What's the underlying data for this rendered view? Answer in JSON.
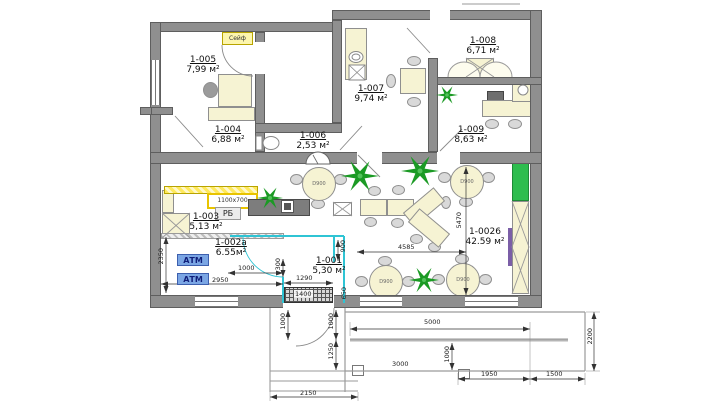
{
  "rooms": {
    "r1005": {
      "id": "1-005",
      "area": "7,99 м²"
    },
    "r1004": {
      "id": "1-004",
      "area": "6,88 м²"
    },
    "r1006": {
      "id": "1-006",
      "area": "2,53 м²"
    },
    "r1007": {
      "id": "1-007",
      "area": "9,74 м²"
    },
    "r1008": {
      "id": "1-008",
      "area": "6,71 м²"
    },
    "r1009": {
      "id": "1-009",
      "area": "8,63 м²"
    },
    "r1003": {
      "id": "1-003",
      "area": "5,13 м²"
    },
    "r1002a": {
      "id": "1-002а",
      "area": "6.55м²"
    },
    "r1001": {
      "id": "1-001",
      "area": "5,30 м²"
    },
    "r10026": {
      "id": "1-0026",
      "area": "42.59 м²"
    }
  },
  "labels": {
    "safe": "Сейф",
    "atm": "АТМ",
    "cash_desk": "РБ",
    "desk_size": "1100x700",
    "round_table": "D900"
  },
  "dimensions": {
    "d2350": "2350",
    "d2950": "2950",
    "d1000_atm": "1000",
    "d300": "300",
    "d900": "900",
    "d1290": "1290",
    "d1400": "1400",
    "d650": "650",
    "d4585": "4585",
    "d5470": "5470",
    "d5000": "5000",
    "d3000": "3000",
    "d1000_porch": "1000",
    "d1950": "1950",
    "d1500": "1500",
    "d2200": "2200",
    "d2150": "2150",
    "d1000_step_left": "1000",
    "d1000_step_right": "1000",
    "d1250": "1250"
  },
  "colors": {
    "wall": "#8f8f8f",
    "furniture": "#f6f3d3",
    "plant": "#1b9a24",
    "teal_partition": "#2fc4d4",
    "atm_fill": "#7ba6e4",
    "atm_text": "#101f7a",
    "green_cabinet": "#2ebd4e",
    "accent_yellow": "#ffe95c"
  }
}
